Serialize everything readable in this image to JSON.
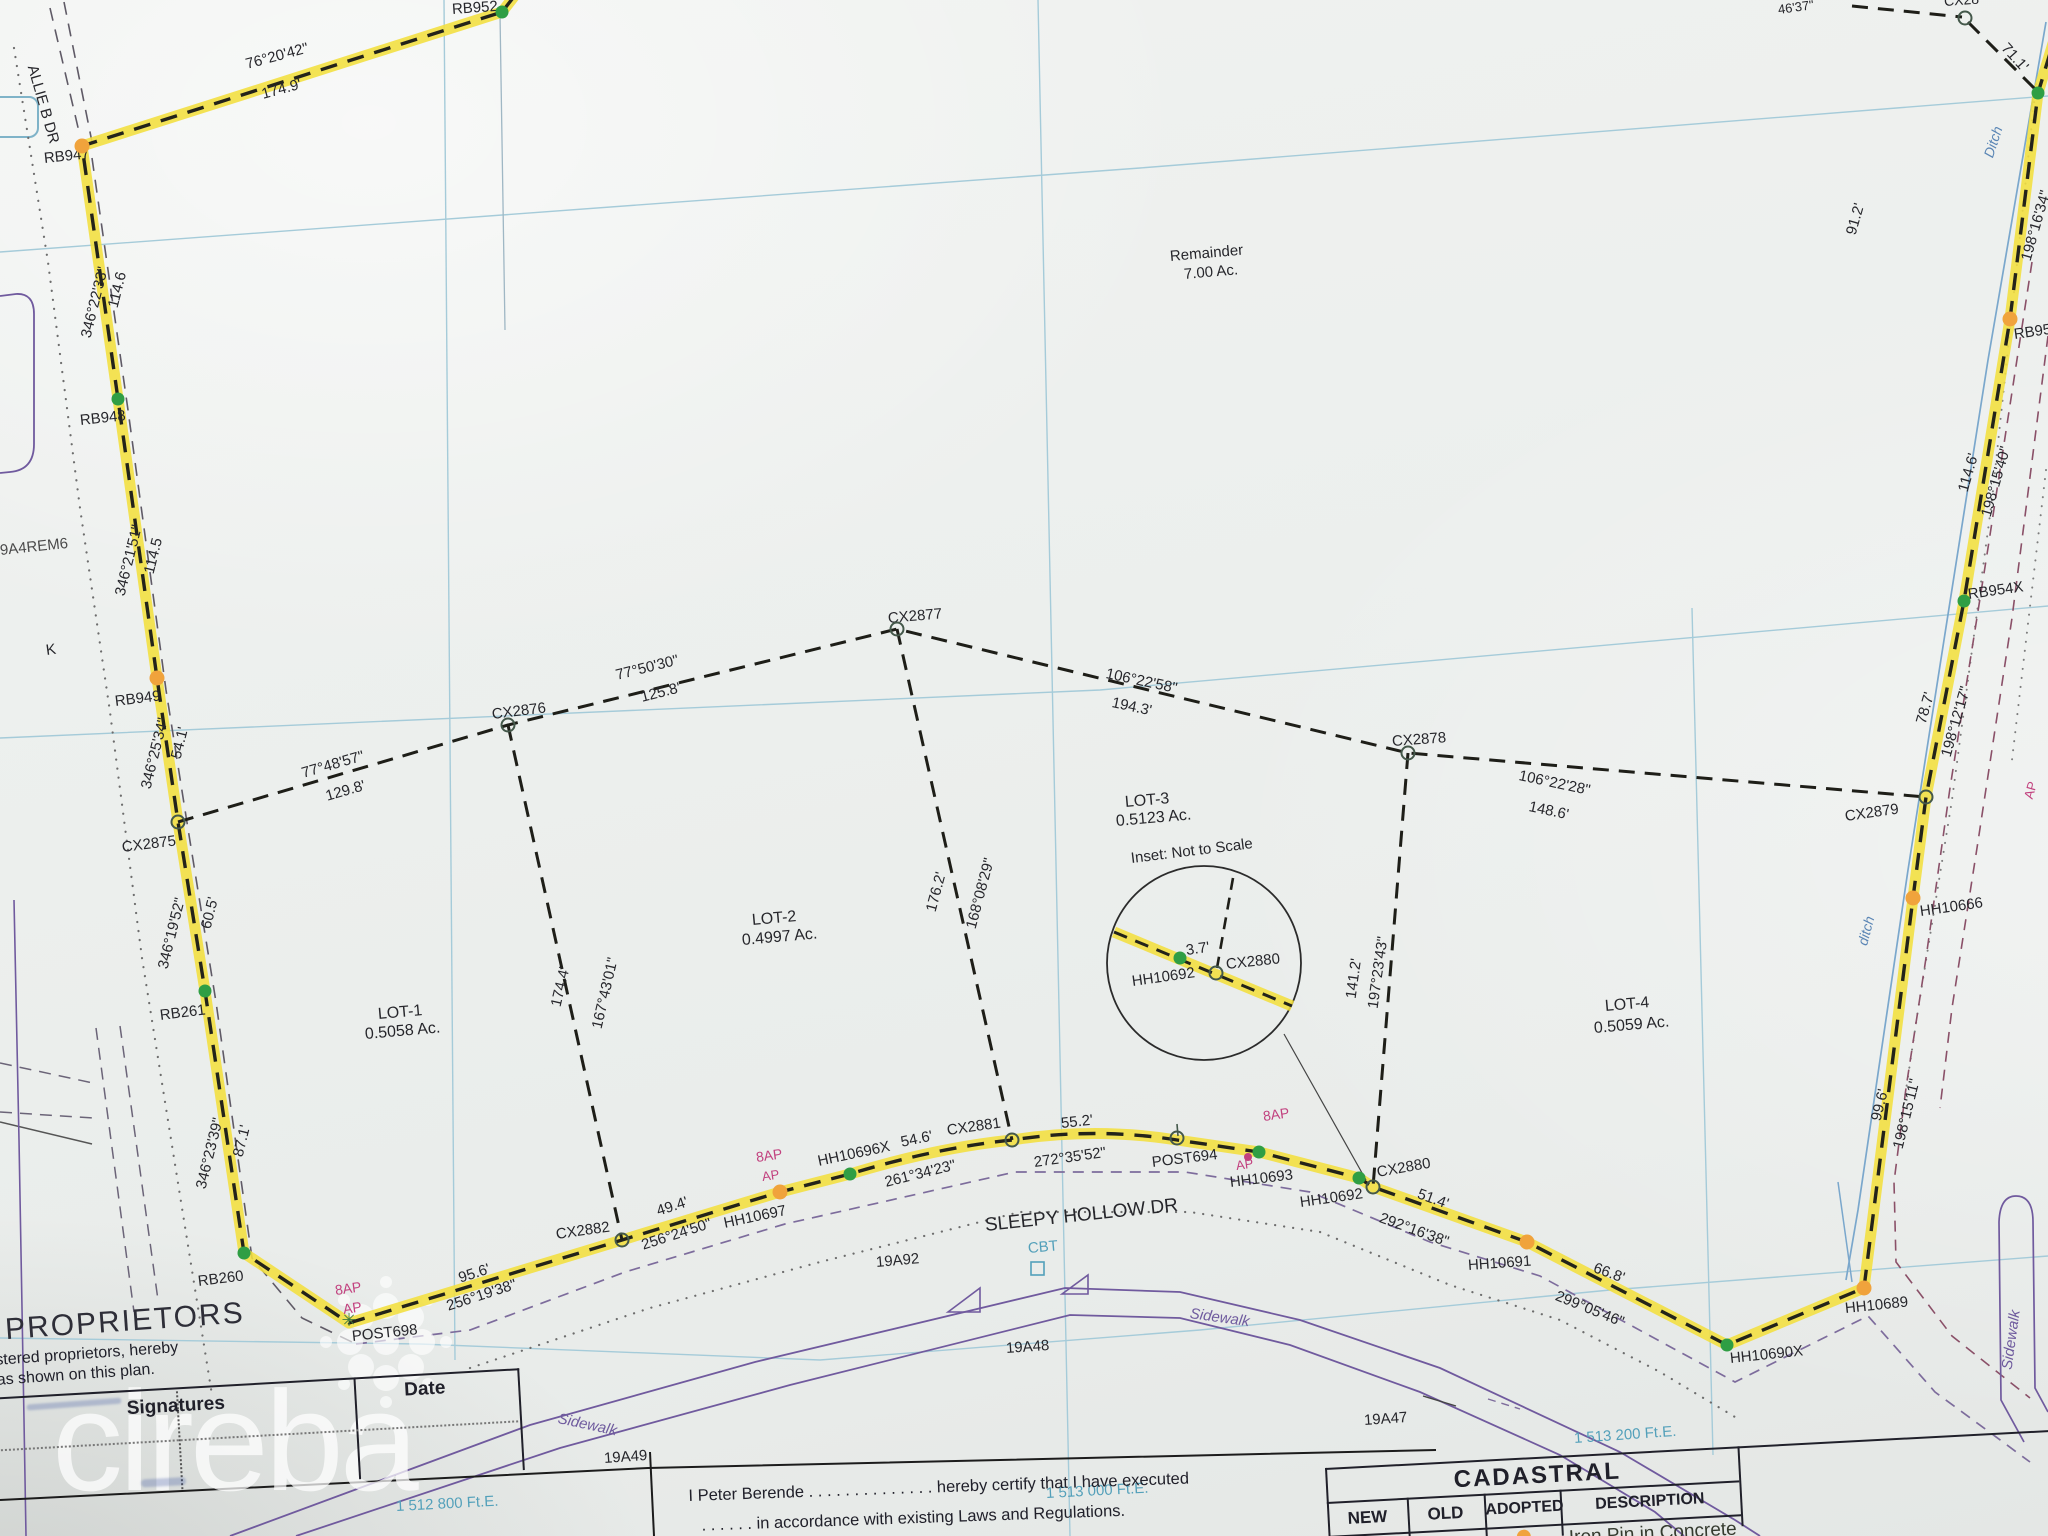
{
  "watermark": {
    "text": "cireba"
  },
  "colors": {
    "boundary_highlight": "#f2df3e",
    "monument_green": "#2f9e44",
    "monument_orange": "#f0a33c",
    "ap_pink": "#c2417f",
    "grid_teal": "#a5cbd9"
  },
  "map": {
    "labels": [
      {
        "t": "RB952",
        "x": 452,
        "y": 2,
        "r": -4
      },
      {
        "t": "76°20'42\"",
        "x": 246,
        "y": 57,
        "r": -15
      },
      {
        "t": "174.9'",
        "x": 262,
        "y": 87,
        "r": -15
      },
      {
        "t": "RB947",
        "x": 44,
        "y": 151,
        "r": -6
      },
      {
        "t": "346°22'33\"",
        "x": 86,
        "y": 330,
        "r": -76
      },
      {
        "t": "114.6",
        "x": 113,
        "y": 300,
        "r": -76
      },
      {
        "t": "RB948",
        "x": 80,
        "y": 413,
        "r": -6
      },
      {
        "t": "346°21'51\"",
        "x": 120,
        "y": 588,
        "r": -76
      },
      {
        "t": "114.5",
        "x": 149,
        "y": 566,
        "r": -76
      },
      {
        "t": "RB949",
        "x": 115,
        "y": 694,
        "r": -7
      },
      {
        "t": "346°25'34\"",
        "x": 146,
        "y": 781,
        "r": -76
      },
      {
        "t": "54.1'",
        "x": 176,
        "y": 751,
        "r": -76
      },
      {
        "t": "CX2875",
        "x": 122,
        "y": 840,
        "r": -7
      },
      {
        "t": "346°19'52\"",
        "x": 163,
        "y": 961,
        "r": -76
      },
      {
        "t": "60.5'",
        "x": 206,
        "y": 921,
        "r": -76
      },
      {
        "t": "RB261",
        "x": 160,
        "y": 1008,
        "r": -7
      },
      {
        "t": "346°23'39\"",
        "x": 201,
        "y": 1181,
        "r": -76
      },
      {
        "t": "87.1'",
        "x": 238,
        "y": 1149,
        "r": -76
      },
      {
        "t": "RB260",
        "x": 198,
        "y": 1274,
        "r": -7
      },
      {
        "t": "8AP",
        "x": 335,
        "y": 1283,
        "r": -8,
        "s": 14,
        "c": "pink"
      },
      {
        "t": "AP",
        "x": 343,
        "y": 1302,
        "r": -8,
        "s": 14,
        "c": "pink"
      },
      {
        "t": "POST698",
        "x": 352,
        "y": 1329,
        "r": -6
      },
      {
        "t": "95.6'",
        "x": 459,
        "y": 1271,
        "r": -18
      },
      {
        "t": "256°19'38\"",
        "x": 447,
        "y": 1299,
        "r": -18
      },
      {
        "t": "CX2882",
        "x": 556,
        "y": 1227,
        "r": -8
      },
      {
        "t": "49.4'",
        "x": 657,
        "y": 1204,
        "r": -18
      },
      {
        "t": "256°24'50\"",
        "x": 642,
        "y": 1238,
        "r": -18
      },
      {
        "t": "HH10697",
        "x": 724,
        "y": 1216,
        "r": -12
      },
      {
        "t": "8AP",
        "x": 756,
        "y": 1150,
        "r": -8,
        "s": 14,
        "c": "pink"
      },
      {
        "t": "AP",
        "x": 762,
        "y": 1170,
        "r": -8,
        "s": 13,
        "c": "pink"
      },
      {
        "t": "HH10696X",
        "x": 818,
        "y": 1154,
        "r": -12
      },
      {
        "t": "54.6'",
        "x": 901,
        "y": 1135,
        "r": -12
      },
      {
        "t": "261°34'23\"",
        "x": 885,
        "y": 1175,
        "r": -14
      },
      {
        "t": "CX2881",
        "x": 947,
        "y": 1123,
        "r": -8
      },
      {
        "t": "55.2'",
        "x": 1061,
        "y": 1116,
        "r": -6
      },
      {
        "t": "272°35'52\"",
        "x": 1034,
        "y": 1155,
        "r": -8
      },
      {
        "t": "POST694",
        "x": 1152,
        "y": 1155,
        "r": -7
      },
      {
        "t": "8AP",
        "x": 1263,
        "y": 1109,
        "r": -8,
        "s": 14,
        "c": "pink"
      },
      {
        "t": "AP",
        "x": 1236,
        "y": 1159,
        "r": -8,
        "s": 13,
        "c": "pink"
      },
      {
        "t": "HH10693",
        "x": 1230,
        "y": 1175,
        "r": -7
      },
      {
        "t": "HH10692",
        "x": 1300,
        "y": 1195,
        "r": -8
      },
      {
        "t": "CX2880",
        "x": 1377,
        "y": 1165,
        "r": -10
      },
      {
        "t": "51.4'",
        "x": 1418,
        "y": 1186,
        "r": 20
      },
      {
        "t": "292°16'38\"",
        "x": 1380,
        "y": 1210,
        "r": 20
      },
      {
        "t": "HH10691",
        "x": 1468,
        "y": 1258,
        "r": -4
      },
      {
        "t": "66.8'",
        "x": 1594,
        "y": 1260,
        "r": 20
      },
      {
        "t": "299°05'46\"",
        "x": 1556,
        "y": 1288,
        "r": 22
      },
      {
        "t": "HH10690X",
        "x": 1730,
        "y": 1351,
        "r": -6
      },
      {
        "t": "HH10689",
        "x": 1845,
        "y": 1301,
        "r": -6
      },
      {
        "t": "99.6'",
        "x": 1876,
        "y": 1113,
        "r": -76
      },
      {
        "t": "198°15'11\"",
        "x": 1898,
        "y": 1141,
        "r": -76
      },
      {
        "t": "HH10666",
        "x": 1920,
        "y": 904,
        "r": -8
      },
      {
        "t": "ditch",
        "x": 1862,
        "y": 938,
        "r": -75,
        "s": 14,
        "c": "blue-i"
      },
      {
        "t": "CX2879",
        "x": 1845,
        "y": 809,
        "r": -8
      },
      {
        "t": "78.7'",
        "x": 1921,
        "y": 716,
        "r": -74
      },
      {
        "t": "198°12'17\"",
        "x": 1946,
        "y": 749,
        "r": -74
      },
      {
        "t": "RB954X",
        "x": 1968,
        "y": 587,
        "r": -8
      },
      {
        "t": "114.6'",
        "x": 1963,
        "y": 484,
        "r": -74
      },
      {
        "t": "198°15'40\"",
        "x": 1986,
        "y": 509,
        "r": -74
      },
      {
        "t": "RB95",
        "x": 2014,
        "y": 327,
        "r": -8
      },
      {
        "t": "91.2'",
        "x": 1851,
        "y": 227,
        "r": -74
      },
      {
        "t": "198°16'34\"",
        "x": 2026,
        "y": 253,
        "r": -74
      },
      {
        "t": "Ditch",
        "x": 1988,
        "y": 150,
        "r": -72,
        "s": 14,
        "c": "blue-i"
      },
      {
        "t": "71.1'",
        "x": 2004,
        "y": 38,
        "r": 48
      },
      {
        "t": "46'37\"",
        "x": 1778,
        "y": 3,
        "r": -8,
        "s": 13
      },
      {
        "t": "CX28",
        "x": 1944,
        "y": -6,
        "r": -4,
        "s": 14
      },
      {
        "t": "CX2876",
        "x": 492,
        "y": 707,
        "r": -7
      },
      {
        "t": "77°48'57\"",
        "x": 302,
        "y": 766,
        "r": -16
      },
      {
        "t": "129.8'",
        "x": 326,
        "y": 789,
        "r": -16
      },
      {
        "t": "77°50'30\"",
        "x": 616,
        "y": 668,
        "r": -14
      },
      {
        "t": "125.8'",
        "x": 641,
        "y": 690,
        "r": -14
      },
      {
        "t": "CX2877",
        "x": 888,
        "y": 611,
        "r": -5
      },
      {
        "t": "106°22'58\"",
        "x": 1106,
        "y": 666,
        "r": 12
      },
      {
        "t": "194.3'",
        "x": 1112,
        "y": 695,
        "r": 12
      },
      {
        "t": "CX2878",
        "x": 1392,
        "y": 734,
        "r": -4
      },
      {
        "t": "106°22'28\"",
        "x": 1519,
        "y": 768,
        "r": 12
      },
      {
        "t": "148.6'",
        "x": 1529,
        "y": 799,
        "r": 12
      },
      {
        "t": "174.4'",
        "x": 556,
        "y": 999,
        "r": -77
      },
      {
        "t": "167°43'01\"",
        "x": 597,
        "y": 1021,
        "r": -77
      },
      {
        "t": "176.2'",
        "x": 931,
        "y": 904,
        "r": -75
      },
      {
        "t": "168°08'29\"",
        "x": 971,
        "y": 921,
        "r": -75
      },
      {
        "t": "141.2'",
        "x": 1351,
        "y": 991,
        "r": -82
      },
      {
        "t": "197°23'43\"",
        "x": 1373,
        "y": 1001,
        "r": -82
      },
      {
        "t": "Remainder",
        "x": 1170,
        "y": 249,
        "r": -5
      },
      {
        "t": "7.00 Ac.",
        "x": 1184,
        "y": 267,
        "r": -5
      },
      {
        "t": "LOT-1",
        "x": 378,
        "y": 1007,
        "r": -5,
        "s": 16
      },
      {
        "t": "0.5058 Ac.",
        "x": 365,
        "y": 1027,
        "r": -5,
        "s": 16
      },
      {
        "t": "LOT-2",
        "x": 752,
        "y": 913,
        "r": -5,
        "s": 16
      },
      {
        "t": "0.4997 Ac.",
        "x": 742,
        "y": 933,
        "r": -5,
        "s": 16
      },
      {
        "t": "LOT-3",
        "x": 1125,
        "y": 795,
        "r": -5,
        "s": 16
      },
      {
        "t": "0.5123 Ac.",
        "x": 1116,
        "y": 814,
        "r": -5,
        "s": 16
      },
      {
        "t": "LOT-4",
        "x": 1605,
        "y": 999,
        "r": -5,
        "s": 16
      },
      {
        "t": "0.5059 Ac.",
        "x": 1594,
        "y": 1021,
        "r": -5,
        "s": 16
      },
      {
        "t": "Inset: Not to Scale",
        "x": 1131,
        "y": 851,
        "r": -7
      },
      {
        "t": "HH10692",
        "x": 1132,
        "y": 974,
        "r": -8
      },
      {
        "t": "3.7'",
        "x": 1186,
        "y": 943,
        "r": -8
      },
      {
        "t": "CX2880",
        "x": 1226,
        "y": 957,
        "r": -6
      },
      {
        "t": "SLEEPY HOLLOW DR",
        "x": 985,
        "y": 1216,
        "r": -6,
        "s": 19
      },
      {
        "t": "CBT",
        "x": 1028,
        "y": 1241,
        "r": -5,
        "c": "teal"
      },
      {
        "t": "19A92",
        "x": 876,
        "y": 1255,
        "r": -5
      },
      {
        "t": "19A48",
        "x": 1006,
        "y": 1341,
        "r": -4
      },
      {
        "t": "19A47",
        "x": 1364,
        "y": 1413,
        "r": -4
      },
      {
        "t": "19A49",
        "x": 604,
        "y": 1451,
        "r": -4
      },
      {
        "t": "1 512 800 Ft.E.",
        "x": 396,
        "y": 1499,
        "r": -3,
        "c": "teal"
      },
      {
        "t": "1 513 000 Ft.E.",
        "x": 1046,
        "y": 1486,
        "r": -3,
        "c": "teal"
      },
      {
        "t": "1 513 200 Ft.E.",
        "x": 1574,
        "y": 1431,
        "r": -4,
        "c": "teal"
      },
      {
        "t": "ALLIE B DR",
        "x": 32,
        "y": 58,
        "r": 74
      },
      {
        "t": "Sidewalk",
        "x": 1190,
        "y": 1306,
        "r": 8,
        "c": "purple-i"
      },
      {
        "t": "Sidewalk",
        "x": 558,
        "y": 1411,
        "r": 12,
        "c": "purple-i"
      },
      {
        "t": "Sidewalk",
        "x": 2007,
        "y": 1362,
        "r": -82,
        "c": "purple-i"
      },
      {
        "t": "9A4REM6",
        "x": 0,
        "y": 543,
        "r": -6,
        "c": "gray"
      },
      {
        "t": "K",
        "x": 46,
        "y": 643,
        "r": -8
      },
      {
        "t": "AP",
        "x": 2028,
        "y": 792,
        "r": -74,
        "s": 13,
        "c": "pink"
      }
    ],
    "points": [
      {
        "x": 502,
        "y": 12,
        "k": "g"
      },
      {
        "x": 118,
        "y": 399,
        "k": "g"
      },
      {
        "x": 205,
        "y": 991,
        "k": "g"
      },
      {
        "x": 244,
        "y": 1253,
        "k": "g"
      },
      {
        "x": 850,
        "y": 1174,
        "k": "g"
      },
      {
        "x": 1259,
        "y": 1152,
        "k": "g"
      },
      {
        "x": 1359,
        "y": 1178,
        "k": "g"
      },
      {
        "x": 1727,
        "y": 1345,
        "k": "g"
      },
      {
        "x": 1964,
        "y": 601,
        "k": "g"
      },
      {
        "x": 2038,
        "y": 93,
        "k": "g"
      },
      {
        "x": 1180,
        "y": 958,
        "k": "g"
      },
      {
        "x": 82,
        "y": 146,
        "k": "o"
      },
      {
        "x": 157,
        "y": 678,
        "k": "o"
      },
      {
        "x": 780,
        "y": 1192,
        "k": "o"
      },
      {
        "x": 1527,
        "y": 1242,
        "k": "o"
      },
      {
        "x": 1864,
        "y": 1288,
        "k": "o"
      },
      {
        "x": 1913,
        "y": 898,
        "k": "o"
      },
      {
        "x": 2010,
        "y": 319,
        "k": "o"
      },
      {
        "x": 178,
        "y": 822,
        "k": "c"
      },
      {
        "x": 508,
        "y": 725,
        "k": "c"
      },
      {
        "x": 897,
        "y": 629,
        "k": "c"
      },
      {
        "x": 1408,
        "y": 753,
        "k": "c"
      },
      {
        "x": 1926,
        "y": 797,
        "k": "c"
      },
      {
        "x": 1012,
        "y": 1140,
        "k": "c"
      },
      {
        "x": 622,
        "y": 1240,
        "k": "c"
      },
      {
        "x": 1373,
        "y": 1187,
        "k": "c"
      },
      {
        "x": 1216,
        "y": 973,
        "k": "c"
      },
      {
        "x": 1965,
        "y": 18,
        "k": "c"
      },
      {
        "x": 1177,
        "y": 1138,
        "k": "c"
      },
      {
        "x": 1248,
        "y": 1157,
        "k": "pk"
      },
      {
        "x": 349,
        "y": 1320,
        "k": "st"
      }
    ]
  },
  "bottom_form": {
    "signatures_label": "Signatures",
    "date_label": "Date",
    "proprietors_title": "PROPRIETORS",
    "proprietors_line1": "stered proprietors, hereby",
    "proprietors_line2": "as shown on this plan.",
    "certify_line1": "I Peter Berende  . . . . . . . . . . . . . .  hereby certify that I have executed",
    "certify_line2": ". . . . . .  in accordance with existing Laws and Regulations.",
    "cadastral_title": "CADASTRAL",
    "cadastral_headers": [
      "NEW",
      "OLD",
      "ADOPTED",
      "DESCRIPTION"
    ],
    "cadastral_row_description": "Iron Pin in Concrete"
  }
}
